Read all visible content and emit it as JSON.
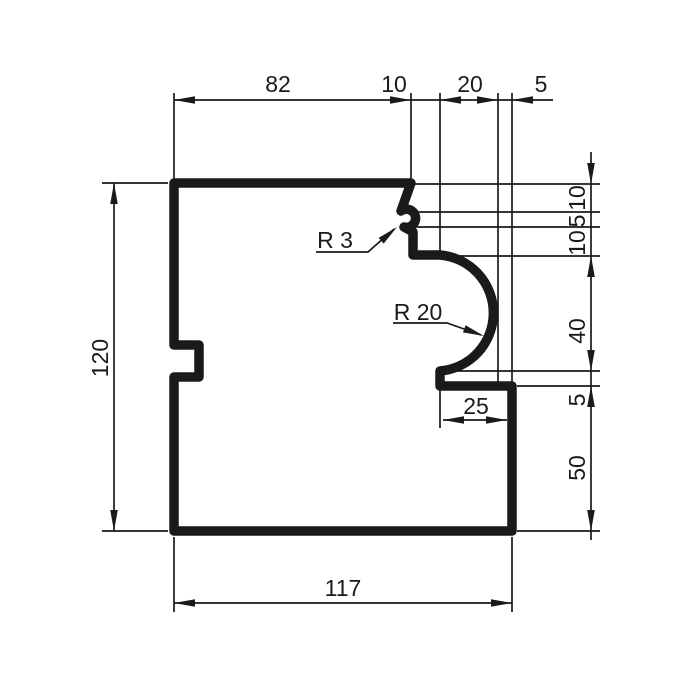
{
  "drawing_title": "Profile cross-section technical drawing",
  "dimensions": {
    "top": [
      "82",
      "10",
      "20",
      "5"
    ],
    "right": [
      "10",
      "5",
      "10",
      "40",
      "5",
      "50"
    ],
    "left": [
      "120"
    ],
    "bottom": [
      "117"
    ],
    "inner": [
      "25"
    ]
  },
  "radius_labels": [
    "R 3",
    "R 20"
  ],
  "colors": {
    "ink": "#1a1a1a",
    "background": "#ffffff"
  }
}
